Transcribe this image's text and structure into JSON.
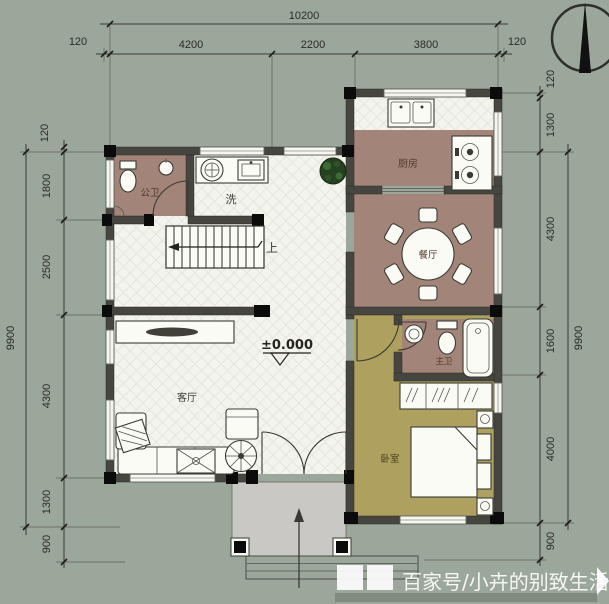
{
  "colors": {
    "background": "#9ba79b",
    "floor_light": "#f4f4ee",
    "floor_brown": "#a28578",
    "floor_olive": "#aea05e",
    "porch_gray": "#c9c8c4",
    "wall": "#46453f"
  },
  "dimensions": {
    "top": {
      "total": "10200",
      "segments": [
        "120",
        "4200",
        "2200",
        "3800",
        "120"
      ]
    },
    "left": {
      "total": "9900",
      "segments": [
        "120",
        "1800",
        "2500",
        "4300",
        "1300",
        "900"
      ]
    },
    "right": {
      "total": "9900",
      "segments": [
        "120",
        "1300",
        "4300",
        "1600",
        "4000",
        "900"
      ]
    }
  },
  "labels": {
    "public_bathroom": "公卫",
    "laundry": "洗",
    "stairs_up": "上",
    "kitchen": "厨房",
    "dining_room": "餐厅",
    "living_room": "客厅",
    "master_bathroom": "主卫",
    "bedroom": "卧室",
    "elevation": "±0.000"
  },
  "icons": {
    "compass": "north-compass"
  },
  "watermark": {
    "text": "百家号/小卉的别致生活"
  }
}
